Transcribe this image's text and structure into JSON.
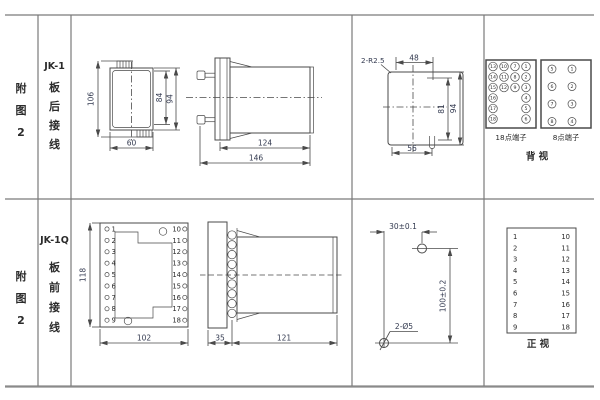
{
  "colors": {
    "line": "#4a4a4a",
    "dim_text": "#333a50",
    "label_text": "#2b2b2b",
    "border": "#7a7a7a"
  },
  "sidebar": {
    "row1": {
      "fig": [
        "附",
        "图",
        "2"
      ],
      "model": "JK-1",
      "wiring": [
        "板",
        "后",
        "接",
        "线"
      ]
    },
    "row2": {
      "fig": [
        "附",
        "图",
        "2"
      ],
      "model": "JK-1Q",
      "wiring": [
        "板",
        "前",
        "接",
        "线"
      ]
    }
  },
  "jk1": {
    "front": {
      "dim_height_overall": "106",
      "dim_height_inner": "84",
      "dim_height_outer": "94",
      "dim_width": "60"
    },
    "side": {
      "dim_body_length": "124",
      "dim_total_length": "146"
    },
    "cutout": {
      "radius_label": "2-R2.5",
      "dim_top_width": "48",
      "dim_inner_height": "81",
      "dim_outer_height": "94",
      "dim_bottom_width": "56"
    },
    "rear": {
      "block18_label": "18点端子",
      "block18": [
        "13",
        "10",
        "7",
        "1",
        "14",
        "11",
        "8",
        "2",
        "15",
        "12",
        "9",
        "3",
        "16",
        "4",
        "17",
        "5",
        "18",
        "6"
      ],
      "block8_label": "8点端子",
      "block8": [
        "5",
        "1",
        "6",
        "2",
        "7",
        "3",
        "8",
        "4"
      ],
      "view_label": "背  视"
    }
  },
  "jk1q": {
    "front": {
      "dim_height": "118",
      "dim_width": "102",
      "left": [
        "1",
        "2",
        "3",
        "4",
        "5",
        "6",
        "7",
        "8",
        "9"
      ],
      "right": [
        "10",
        "11",
        "12",
        "13",
        "14",
        "15",
        "16",
        "17",
        "18"
      ]
    },
    "side": {
      "dim_plate": "35",
      "dim_body": "121"
    },
    "drill": {
      "dim_x": "30±0.1",
      "dim_y": "100±0.2",
      "hole_label": "2-Ø5"
    },
    "table": {
      "left": [
        "1",
        "2",
        "3",
        "4",
        "5",
        "6",
        "7",
        "8",
        "9"
      ],
      "right": [
        "10",
        "11",
        "12",
        "13",
        "14",
        "15",
        "16",
        "17",
        "18"
      ],
      "view_label": "正  视"
    }
  }
}
